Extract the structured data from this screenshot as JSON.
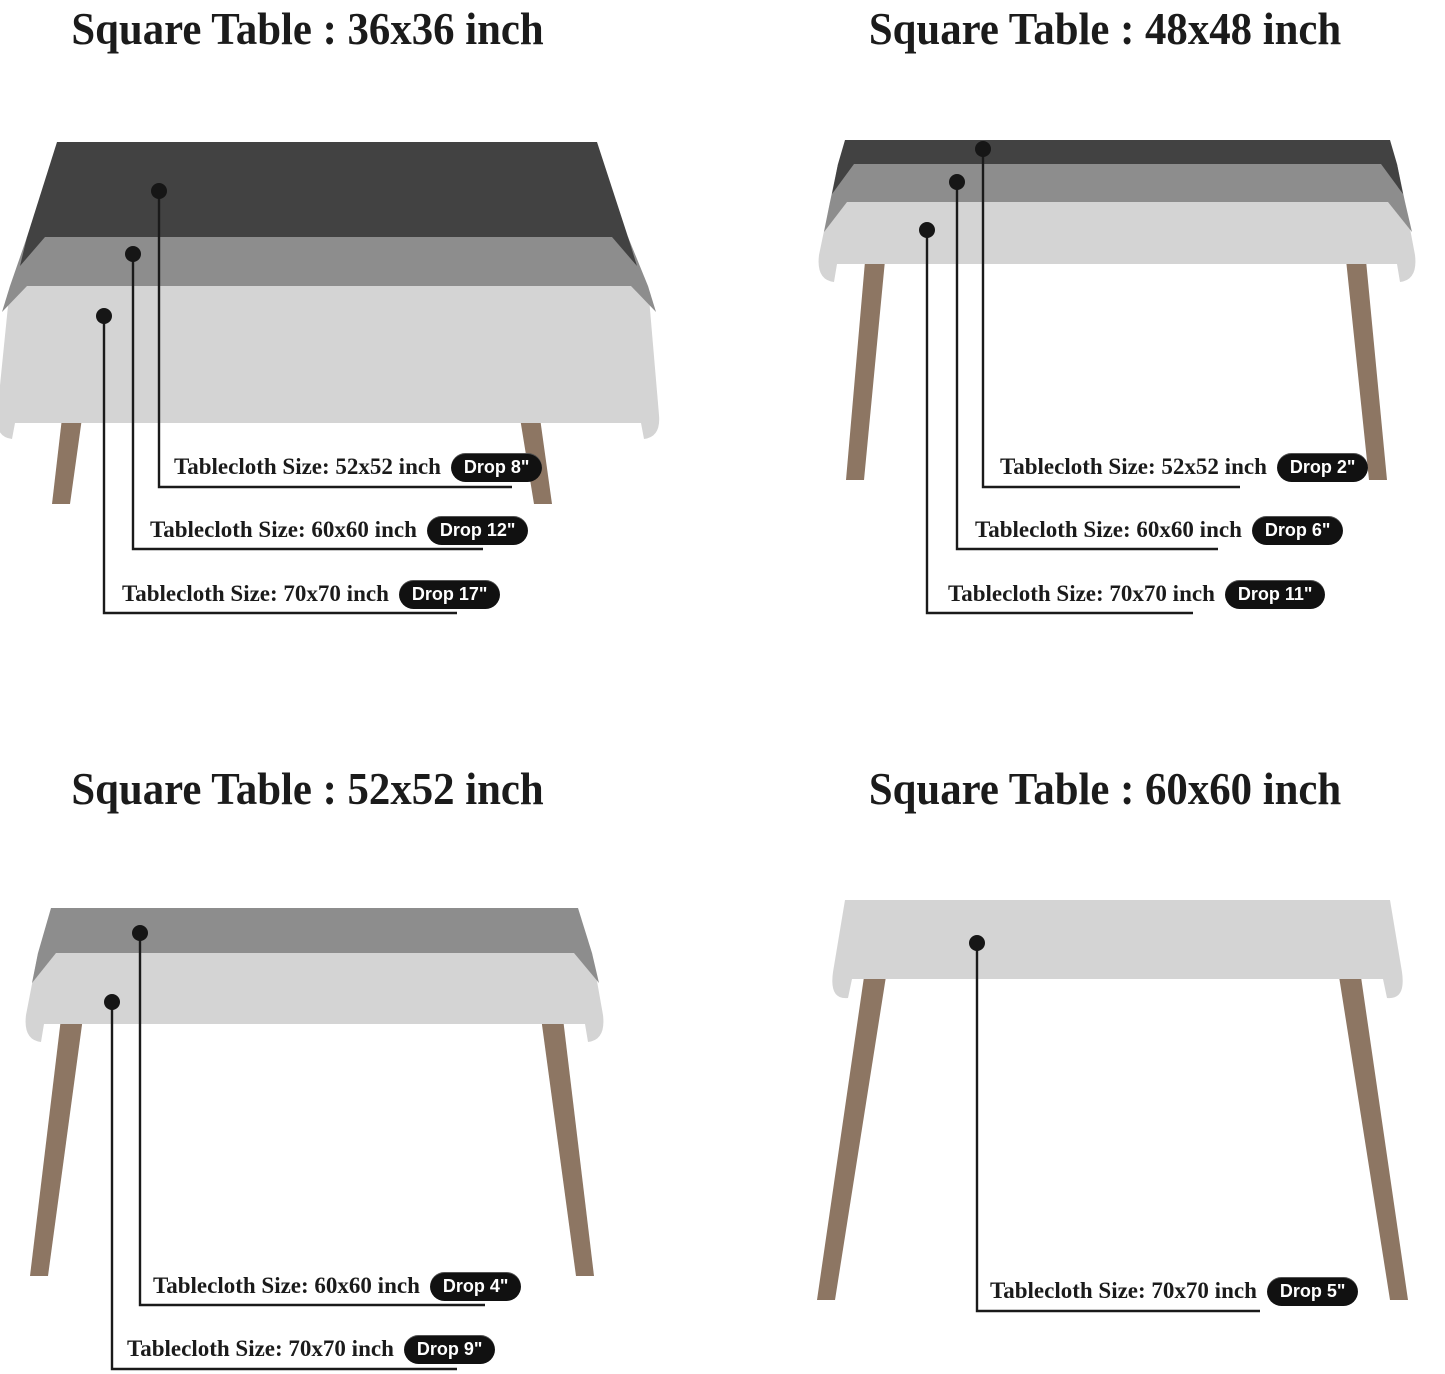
{
  "colors": {
    "background": "#ffffff",
    "text": "#1b1b1b",
    "leader_line": "#1a1a1a",
    "cloth_dark": "#424242",
    "cloth_medium": "#8d8d8d",
    "cloth_light": "#d4d4d4",
    "leg": "#8d7663",
    "pill_bg": "#111111",
    "pill_text": "#ffffff"
  },
  "diagrams": [
    {
      "title": "Square Table : 36x36 inch",
      "labels": [
        {
          "text": "Tablecloth Size: 52x52 inch",
          "drop": "Drop 8\""
        },
        {
          "text": "Tablecloth Size: 60x60 inch",
          "drop": "Drop 12\""
        },
        {
          "text": "Tablecloth Size: 70x70 inch",
          "drop": "Drop 17\""
        }
      ]
    },
    {
      "title": "Square Table : 48x48 inch",
      "labels": [
        {
          "text": "Tablecloth Size: 52x52 inch",
          "drop": "Drop 2\""
        },
        {
          "text": "Tablecloth Size: 60x60 inch",
          "drop": "Drop 6\""
        },
        {
          "text": "Tablecloth Size: 70x70 inch",
          "drop": "Drop 11\""
        }
      ]
    },
    {
      "title": "Square Table : 52x52 inch",
      "labels": [
        {
          "text": "Tablecloth Size: 60x60 inch",
          "drop": "Drop 4\""
        },
        {
          "text": "Tablecloth Size: 70x70 inch",
          "drop": "Drop 9\""
        }
      ]
    },
    {
      "title": "Square Table : 60x60 inch",
      "labels": [
        {
          "text": "Tablecloth Size: 70x70 inch",
          "drop": "Drop 5\""
        }
      ]
    }
  ]
}
